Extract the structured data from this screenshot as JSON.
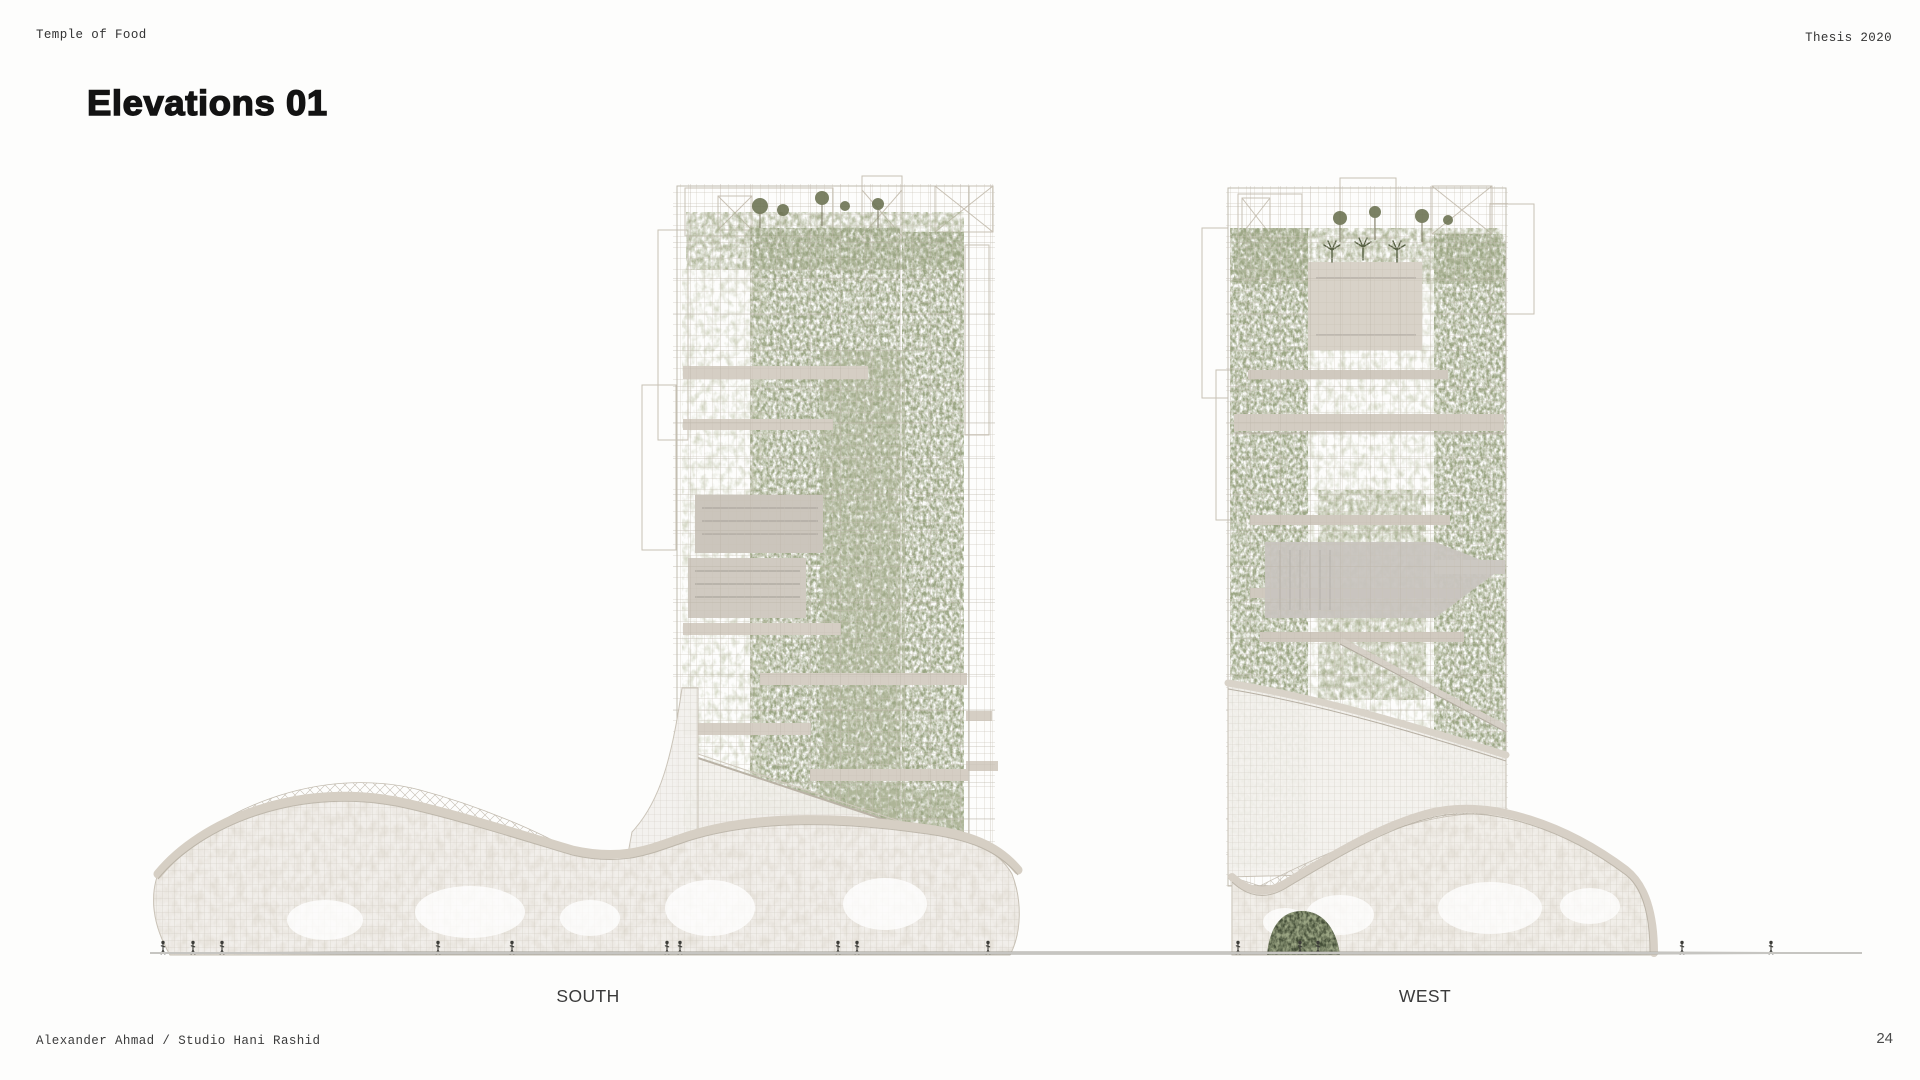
{
  "header": {
    "project": "Temple of Food",
    "context": "Thesis 2020"
  },
  "title": "Elevations 01",
  "figures": [
    {
      "id": "south",
      "label": "SOUTH"
    },
    {
      "id": "west",
      "label": "WEST"
    }
  ],
  "footer": {
    "credit": "Alexander Ahmad / Studio Hani Rashid",
    "page_number": "24"
  },
  "palette": {
    "background": "#fdfdfc",
    "ink": "#131313",
    "foliage_green": "#6b7351",
    "foliage_dark": "#545f3b",
    "slab_beige": "#d5cec4",
    "structure_gray": "#c5beb2",
    "ground_line": "#c6c5c1"
  }
}
